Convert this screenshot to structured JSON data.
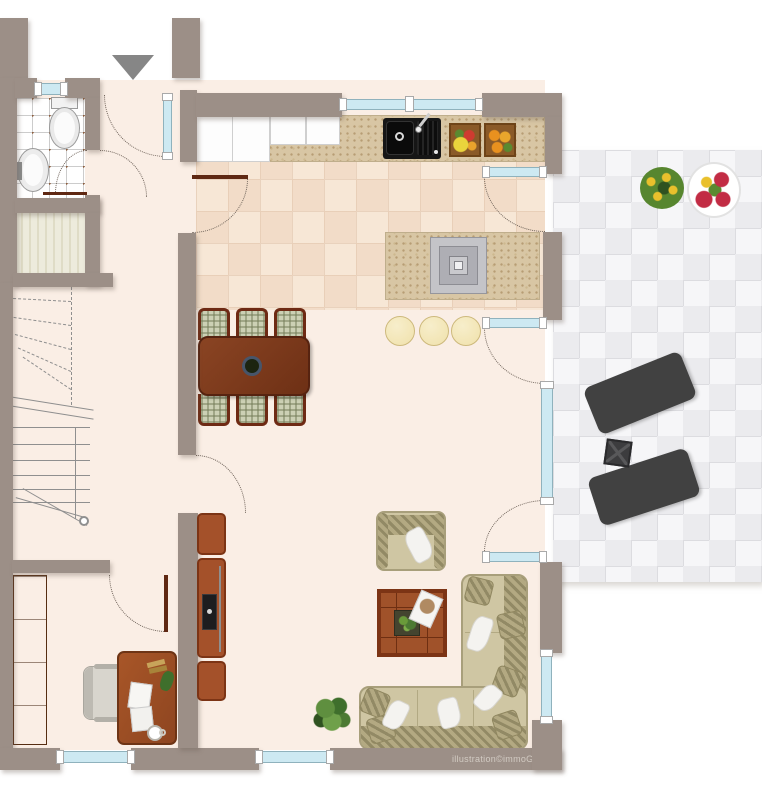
{
  "watermark": "illustration©immoGrafik",
  "icons": {
    "entrance_arrow": "down-triangle"
  },
  "colors": {
    "wall": "#9c8f87",
    "floor": "#faeee5",
    "kitchen_tile": "#f7e7d6",
    "kitchen_line": "#e9d2bd",
    "bath_line": "#cccccc",
    "bath_dot": "#8d5c3c",
    "terrace_light": "#f6f6f8",
    "terrace_dark": "#ebebee",
    "terrace_line": "#dcdce0",
    "glass": "#cde9f2",
    "glass_frame": "#8fb2bd",
    "wood_dark": "#7c3a1d",
    "wood_red": "#a4512a",
    "wood_deep": "#5f2812",
    "counter": "#d8c6a4",
    "speckle": "#b79d74",
    "appliance": "#161616",
    "fabric_plaid": "#ccd0b4",
    "sofa": "#cfc6a3",
    "sofa_edge": "#a89f7b",
    "pillow": "#b3a982",
    "white_throw": "#f4f3f0",
    "stool": "#f0e1ab",
    "stool_edge": "#cdb97c",
    "lounger": "#dbd9d5",
    "lounger_frame": "#414141",
    "plant": "#4c7a33",
    "plant_dark": "#2f5220",
    "flower_red": "#c22c44",
    "flower_yellow": "#e9c02c",
    "arrow": "#868686",
    "stair_line": "#8f8f8f",
    "watermark_color": "#d2cbc3",
    "chair_gray": "#d8d5cd"
  }
}
